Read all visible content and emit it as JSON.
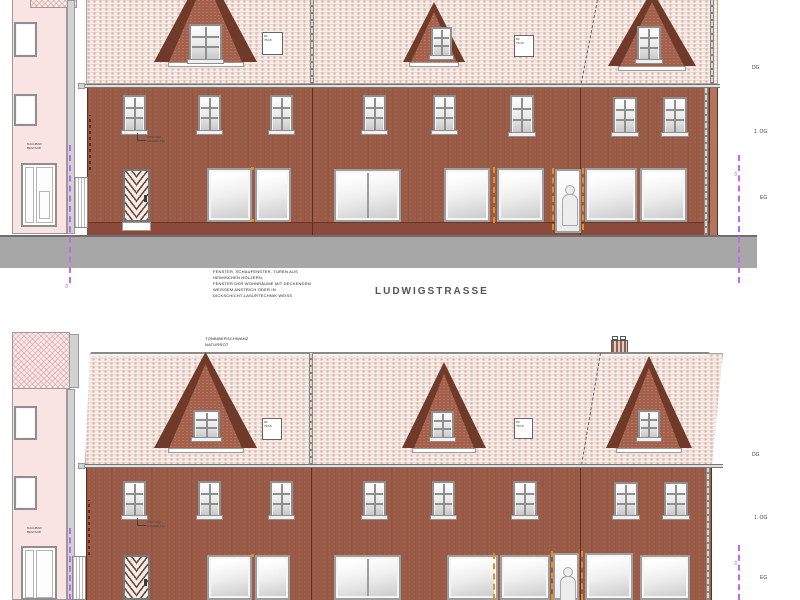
{
  "labels": {
    "street": "LUDWIGSTRASSE",
    "materials_note": [
      "FENSTER, SCHAUFENSTER, TÜREN AUS",
      "HEIMISCHEN HÖLZERN,",
      "FENSTER DER WOHNRÄUME MIT DECKENDEM",
      "WEISSEM ANSTRICH ODER IN",
      "DICKSCHICHT-LASURTECHNIK WEISS"
    ],
    "roof_note": [
      "TONBIBERSCHWANZ",
      "NATURROT"
    ],
    "neighbor": [
      "NACHBAR",
      "BESTAND"
    ],
    "guard": [
      "ABSTURZ-",
      "SICHERUNG"
    ],
    "skylight": [
      "DF",
      "76/18"
    ],
    "floors": [
      "DG",
      "1. OG",
      "EG"
    ],
    "boundary": "Gr."
  },
  "colors": {
    "facade_brick": "#9a5b46",
    "plinth": "#8c4a3a",
    "roof_hatch": "#f6ece8",
    "neighbor_pink": "#fae3e3",
    "boundary_purple": "#c468f0",
    "accent_orange": "#e09020",
    "street_gray": "#a7a7a7"
  }
}
